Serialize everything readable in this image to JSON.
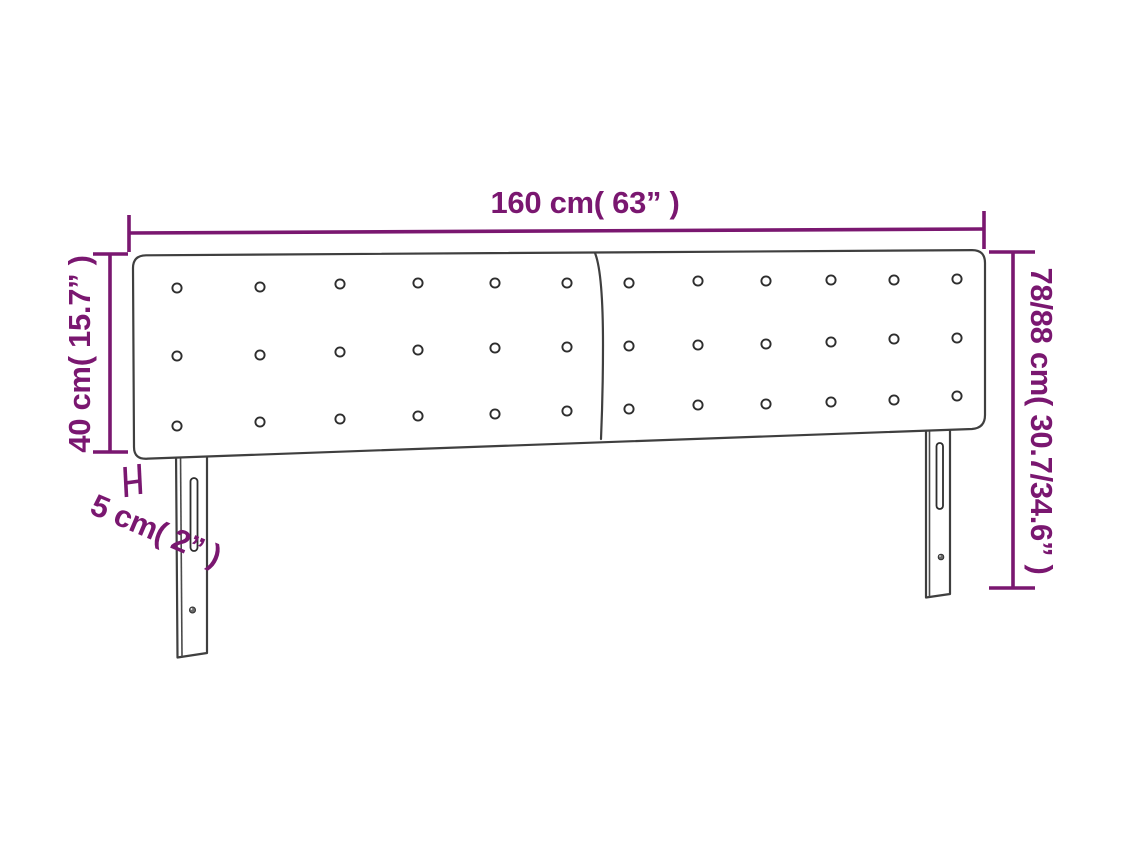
{
  "diagram": {
    "kind": "furniture-dimension-diagram",
    "subject": "two-panel tufted headboard with legs",
    "colors": {
      "annotation": "#7a1770",
      "outline": "#3f3f3f",
      "background": "#ffffff"
    },
    "labels": {
      "width": "160 cm( 63” )",
      "panel_height": "40 cm( 15.7” )",
      "thickness": "5 cm( 2” )",
      "total_height": "78/88 cm( 30.7/34.6” )"
    }
  }
}
